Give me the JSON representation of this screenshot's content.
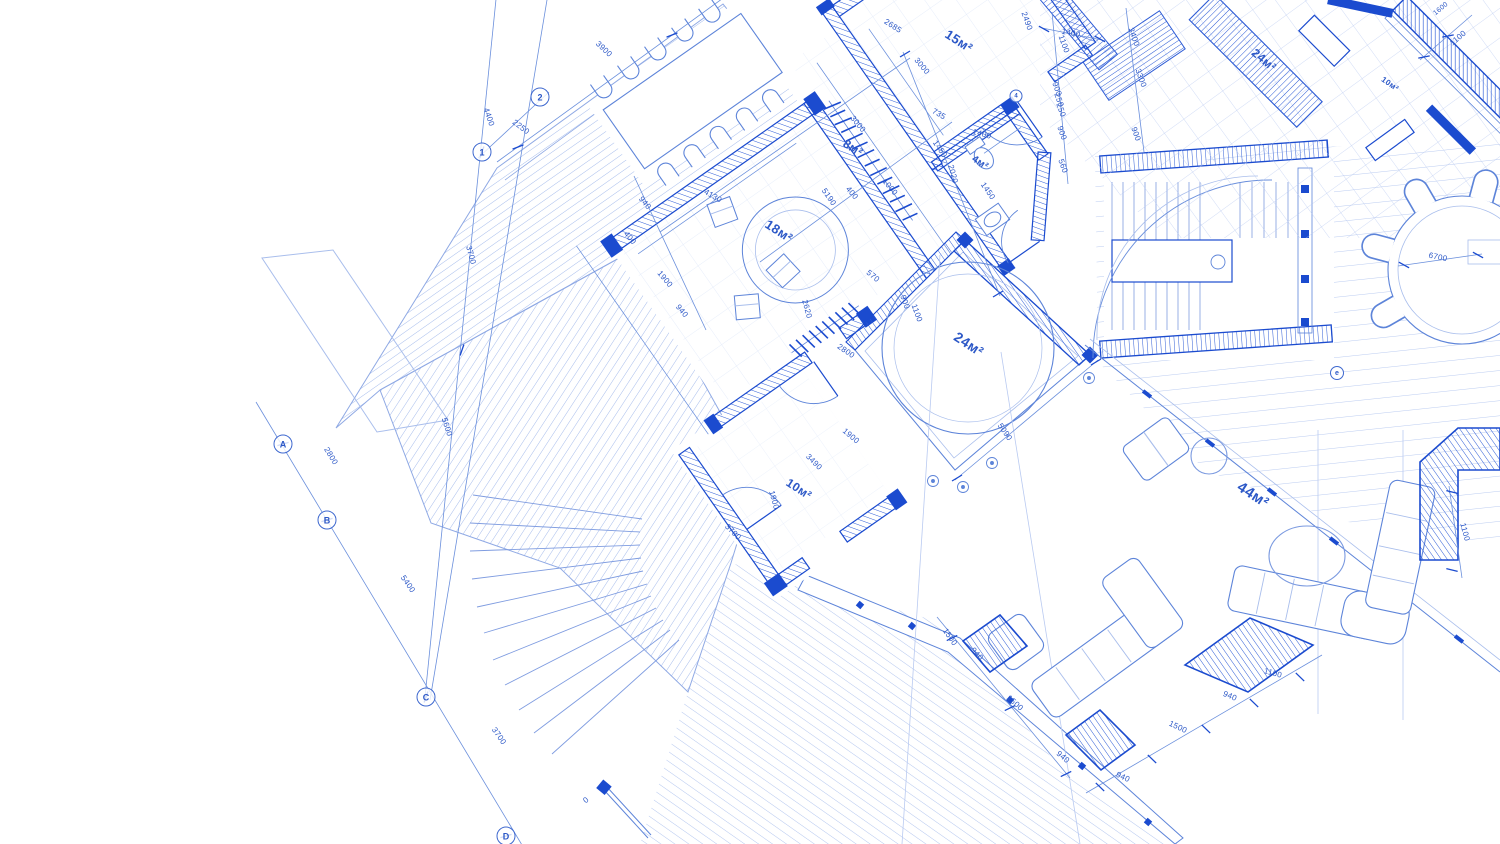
{
  "palette": {
    "wall": "#1b4bcf",
    "line": "#5d84d9",
    "faint": "#a9beec",
    "text": "#2c58c7",
    "tile": "#ccdaf5",
    "background": "#ffffff"
  },
  "labels": {
    "rooms": [
      {
        "text": "15м²",
        "x": 959,
        "y": 41,
        "rot": 33,
        "size": 13
      },
      {
        "text": "8м²",
        "x": 853,
        "y": 148,
        "rot": 33,
        "size": 12
      },
      {
        "text": "4м²",
        "x": 980,
        "y": 163,
        "rot": 33,
        "size": 10
      },
      {
        "text": "18м²",
        "x": 779,
        "y": 231,
        "rot": 33,
        "size": 13
      },
      {
        "text": "24м²",
        "x": 969,
        "y": 344,
        "rot": 33,
        "size": 14
      },
      {
        "text": "10м²",
        "x": 799,
        "y": 489,
        "rot": 33,
        "size": 12
      },
      {
        "text": "44м²",
        "x": 1253,
        "y": 495,
        "rot": 33,
        "size": 15
      },
      {
        "text": "24м²",
        "x": 1264,
        "y": 60,
        "rot": 40,
        "size": 12
      },
      {
        "text": "10м²",
        "x": 1390,
        "y": 84,
        "rot": 35,
        "size": 8
      }
    ],
    "dimensions": [
      {
        "text": "3900",
        "x": 604,
        "y": 49,
        "rot": 43
      },
      {
        "text": "4400",
        "x": 489,
        "y": 117,
        "rot": 71
      },
      {
        "text": "2250",
        "x": 521,
        "y": 127,
        "rot": 37
      },
      {
        "text": "3700",
        "x": 471,
        "y": 255,
        "rot": 75
      },
      {
        "text": "5600",
        "x": 447,
        "y": 427,
        "rot": 72
      },
      {
        "text": "2800",
        "x": 331,
        "y": 456,
        "rot": 58
      },
      {
        "text": "5400",
        "x": 408,
        "y": 584,
        "rot": 55
      },
      {
        "text": "3700",
        "x": 499,
        "y": 736,
        "rot": 55
      },
      {
        "text": "2685",
        "x": 893,
        "y": 26,
        "rot": 33
      },
      {
        "text": "2490",
        "x": 1027,
        "y": 21,
        "rot": 70
      },
      {
        "text": "1400",
        "x": 1071,
        "y": 33,
        "rot": 12
      },
      {
        "text": "1100",
        "x": 1064,
        "y": 44,
        "rot": 70
      },
      {
        "text": "3400",
        "x": 1134,
        "y": 37,
        "rot": 70
      },
      {
        "text": "3300",
        "x": 1141,
        "y": 78,
        "rot": 70
      },
      {
        "text": "900",
        "x": 1057,
        "y": 89,
        "rot": 70
      },
      {
        "text": "250",
        "x": 1059,
        "y": 100,
        "rot": 70
      },
      {
        "text": "250",
        "x": 1061,
        "y": 110,
        "rot": 70
      },
      {
        "text": "900",
        "x": 1062,
        "y": 133,
        "rot": 70
      },
      {
        "text": "560",
        "x": 1063,
        "y": 166,
        "rot": 70
      },
      {
        "text": "900",
        "x": 1136,
        "y": 134,
        "rot": 70
      },
      {
        "text": "1400",
        "x": 982,
        "y": 134,
        "rot": 15
      },
      {
        "text": "1450",
        "x": 940,
        "y": 149,
        "rot": 55
      },
      {
        "text": "2020",
        "x": 953,
        "y": 174,
        "rot": 75
      },
      {
        "text": "1450",
        "x": 988,
        "y": 191,
        "rot": 55
      },
      {
        "text": "3000",
        "x": 922,
        "y": 66,
        "rot": 50
      },
      {
        "text": "3000",
        "x": 858,
        "y": 124,
        "rot": 50
      },
      {
        "text": "735",
        "x": 939,
        "y": 114,
        "rot": 30
      },
      {
        "text": "4130",
        "x": 713,
        "y": 196,
        "rot": 30
      },
      {
        "text": "5190",
        "x": 829,
        "y": 197,
        "rot": 55
      },
      {
        "text": "2620",
        "x": 807,
        "y": 309,
        "rot": 75
      },
      {
        "text": "2800",
        "x": 846,
        "y": 351,
        "rot": 35
      },
      {
        "text": "940",
        "x": 645,
        "y": 203,
        "rot": 50
      },
      {
        "text": "400",
        "x": 630,
        "y": 238,
        "rot": 50
      },
      {
        "text": "1900",
        "x": 665,
        "y": 279,
        "rot": 50
      },
      {
        "text": "940",
        "x": 682,
        "y": 311,
        "rot": 50
      },
      {
        "text": "400",
        "x": 852,
        "y": 193,
        "rot": 50
      },
      {
        "text": "1000",
        "x": 890,
        "y": 187,
        "rot": 50
      },
      {
        "text": "570",
        "x": 873,
        "y": 276,
        "rot": 40
      },
      {
        "text": "900",
        "x": 905,
        "y": 302,
        "rot": 70
      },
      {
        "text": "1100",
        "x": 917,
        "y": 313,
        "rot": 70
      },
      {
        "text": "1900",
        "x": 851,
        "y": 436,
        "rot": 40
      },
      {
        "text": "3490",
        "x": 814,
        "y": 462,
        "rot": 45
      },
      {
        "text": "1900",
        "x": 774,
        "y": 500,
        "rot": 75
      },
      {
        "text": "3700",
        "x": 733,
        "y": 532,
        "rot": 45
      },
      {
        "text": "5090",
        "x": 1005,
        "y": 432,
        "rot": 55
      },
      {
        "text": "6700",
        "x": 1438,
        "y": 257,
        "rot": 12
      },
      {
        "text": "1500",
        "x": 950,
        "y": 637,
        "rot": 55
      },
      {
        "text": "940",
        "x": 977,
        "y": 654,
        "rot": 48
      },
      {
        "text": "1500",
        "x": 1015,
        "y": 703,
        "rot": 42
      },
      {
        "text": "940",
        "x": 1063,
        "y": 757,
        "rot": 40
      },
      {
        "text": "940",
        "x": 1123,
        "y": 777,
        "rot": 25
      },
      {
        "text": "1500",
        "x": 1178,
        "y": 727,
        "rot": 25
      },
      {
        "text": "940",
        "x": 1230,
        "y": 696,
        "rot": 22
      },
      {
        "text": "1100",
        "x": 1273,
        "y": 673,
        "rot": 15
      },
      {
        "text": "1100",
        "x": 1465,
        "y": 532,
        "rot": 75
      },
      {
        "text": "1100",
        "x": 1458,
        "y": 38,
        "rot": -40
      },
      {
        "text": "1600",
        "x": 1441,
        "y": 9,
        "rot": -40,
        "size": 7
      },
      {
        "text": "0",
        "x": 586,
        "y": 800,
        "rot": -40,
        "size": 8
      }
    ],
    "grid_markers": [
      {
        "text": "2",
        "x": 540,
        "y": 97,
        "d": 17
      },
      {
        "text": "1",
        "x": 482,
        "y": 152,
        "d": 17
      },
      {
        "text": "A",
        "x": 283,
        "y": 444,
        "d": 17
      },
      {
        "text": "B",
        "x": 327,
        "y": 520,
        "d": 17
      },
      {
        "text": "C",
        "x": 426,
        "y": 697,
        "d": 17
      },
      {
        "text": "D",
        "x": 506,
        "y": 836,
        "d": 17
      },
      {
        "text": "e",
        "x": 1337,
        "y": 373,
        "d": 12
      },
      {
        "text": "4",
        "x": 1016,
        "y": 96,
        "d": 11
      }
    ]
  }
}
